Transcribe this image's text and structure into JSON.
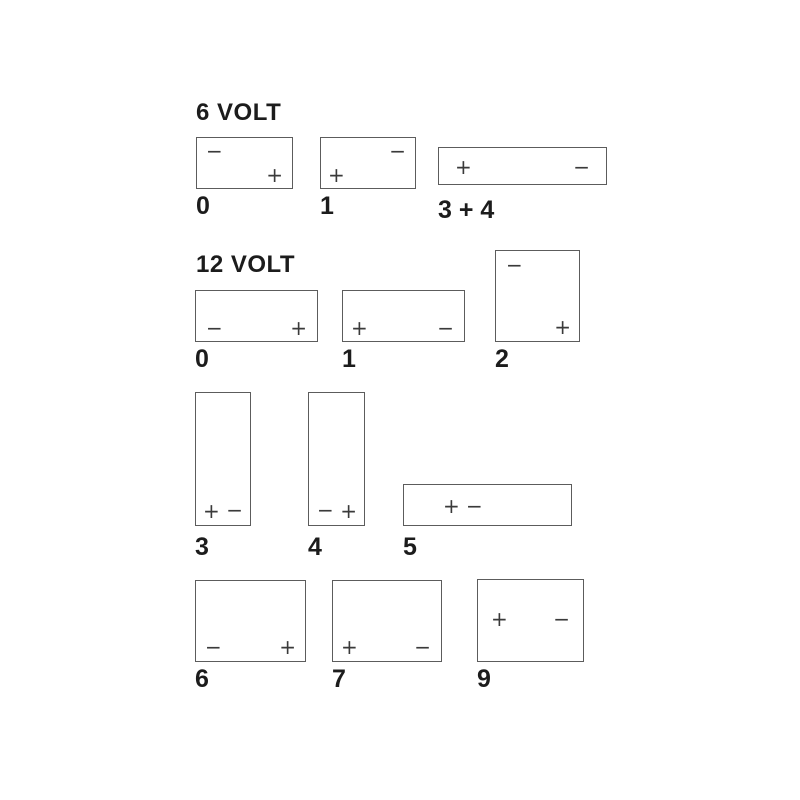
{
  "colors": {
    "background": "#ffffff",
    "line": "#5c5c5c",
    "text": "#1c1c1c",
    "terminal": "#3a3a3a"
  },
  "sections": [
    {
      "title": "6 VOLT",
      "batteries": [
        {
          "label": "0",
          "terminals": [
            {
              "glyph": "−",
              "position": "top-left"
            },
            {
              "glyph": "+",
              "position": "bottom-right"
            }
          ]
        },
        {
          "label": "1",
          "terminals": [
            {
              "glyph": "−",
              "position": "top-right"
            },
            {
              "glyph": "+",
              "position": "bottom-left"
            }
          ]
        },
        {
          "label": "3 + 4",
          "terminals": [
            {
              "glyph": "+",
              "position": "mid-left"
            },
            {
              "glyph": "−",
              "position": "mid-right"
            }
          ]
        }
      ]
    },
    {
      "title": "12 VOLT",
      "batteries": [
        {
          "label": "0",
          "terminals": [
            {
              "glyph": "−",
              "position": "bottom-left"
            },
            {
              "glyph": "+",
              "position": "bottom-right"
            }
          ]
        },
        {
          "label": "1",
          "terminals": [
            {
              "glyph": "+",
              "position": "bottom-left"
            },
            {
              "glyph": "−",
              "position": "bottom-right"
            }
          ]
        },
        {
          "label": "2",
          "terminals": [
            {
              "glyph": "−",
              "position": "top-left"
            },
            {
              "glyph": "+",
              "position": "bottom-right"
            }
          ]
        },
        {
          "label": "3",
          "terminals": [
            {
              "glyph": "+",
              "position": "bottom-left"
            },
            {
              "glyph": "−",
              "position": "bottom-right"
            }
          ]
        },
        {
          "label": "4",
          "terminals": [
            {
              "glyph": "−",
              "position": "bottom-left"
            },
            {
              "glyph": "+",
              "position": "bottom-right"
            }
          ]
        },
        {
          "label": "5",
          "terminals": [
            {
              "glyph": "+",
              "position": "mid-left"
            },
            {
              "glyph": "−",
              "position": "mid-left-inner"
            }
          ]
        },
        {
          "label": "6",
          "terminals": [
            {
              "glyph": "−",
              "position": "bottom-left"
            },
            {
              "glyph": "+",
              "position": "bottom-right"
            }
          ]
        },
        {
          "label": "7",
          "terminals": [
            {
              "glyph": "+",
              "position": "bottom-left"
            },
            {
              "glyph": "−",
              "position": "bottom-right"
            }
          ]
        },
        {
          "label": "9",
          "terminals": [
            {
              "glyph": "+",
              "position": "upper-left"
            },
            {
              "glyph": "−",
              "position": "upper-right"
            }
          ]
        }
      ]
    }
  ]
}
